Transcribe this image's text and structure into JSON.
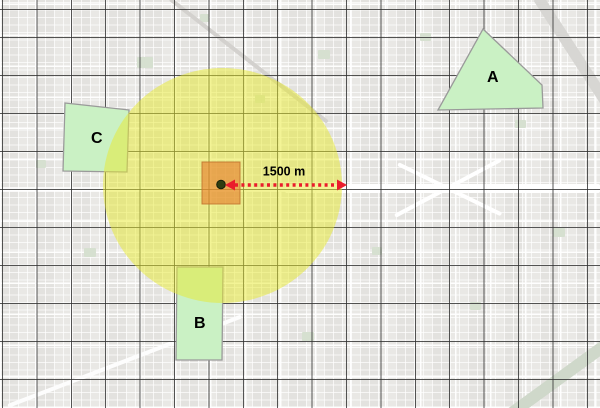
{
  "scene": {
    "distance_label": "1500 m",
    "zones": [
      {
        "label": "A",
        "cx": 493,
        "cy": 78,
        "points": "483,29 542,85 543,108 438,110"
      },
      {
        "label": "B",
        "cx": 200,
        "cy": 324,
        "points": "177,267 223,267 222,360 176,360"
      },
      {
        "label": "C",
        "cx": 97,
        "cy": 139,
        "points": "65,103 129,110 127,172 63,171"
      }
    ],
    "buffer": {
      "cx": 222.5,
      "cy": 185.5,
      "rx": 119.5,
      "ry": 117.5,
      "fill": "#e7ea2d",
      "opacity": 0.5
    },
    "cell": {
      "x": 202,
      "y": 162,
      "width": 38,
      "height": 42,
      "fill": "#e77d2b",
      "opacity": 0.62,
      "stroke": "#c07630"
    },
    "center_point": {
      "cx": 221,
      "cy": 184.5,
      "r": 4.3,
      "fill": "#2f3d10"
    },
    "arrow": {
      "x1": 225,
      "x2": 347,
      "y": 185,
      "color": "#ea1c2c",
      "label_x": 284,
      "label_y": 179
    },
    "colors": {
      "zone_fill": "#caf1c4",
      "zone_stroke": "#9a9a9a",
      "grid_line": "#303030",
      "label_text": "#000000"
    }
  }
}
